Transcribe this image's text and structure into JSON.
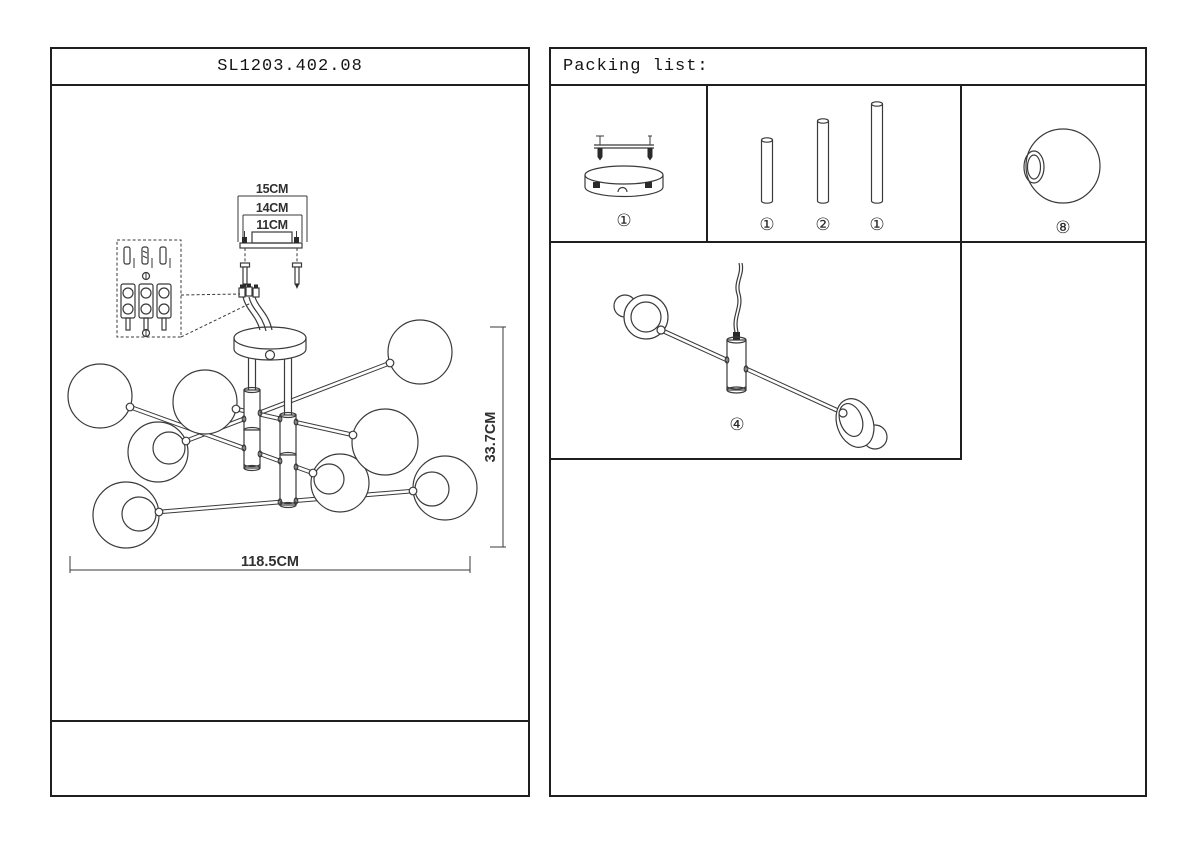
{
  "left_panel": {
    "title": "SL1203.402.08",
    "dims": {
      "bracket_outer": "15CM",
      "bracket_mid": "14CM",
      "bracket_inner": "11CM",
      "height": "33.7CM",
      "width": "118.5CM"
    }
  },
  "right_panel": {
    "title": "Packing list:",
    "qty": {
      "canopy": "①",
      "rod_short": "①",
      "rod_medium": "②",
      "rod_long": "①",
      "globe": "⑧",
      "arm_assembly": "④"
    }
  }
}
